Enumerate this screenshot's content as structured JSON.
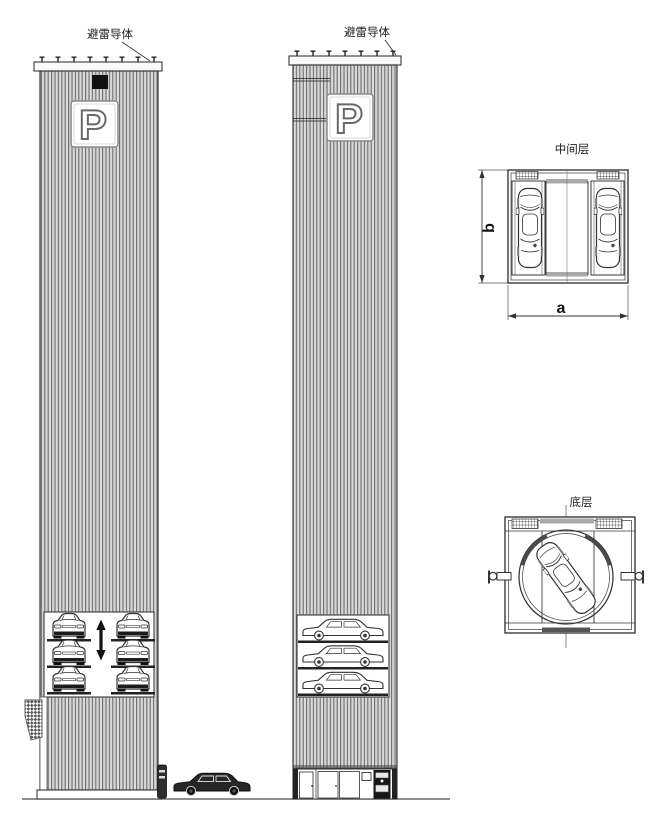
{
  "front_elevation": {
    "lightning_label": "避雷导体",
    "sign_letter": "P",
    "car_count": 6
  },
  "side_elevation": {
    "lightning_label": "避雷导体",
    "sign_letter": "P",
    "car_count": 3
  },
  "middle_floor_plan": {
    "title": "中间层",
    "dim_width_label": "a",
    "dim_depth_label": "b",
    "car_count": 2
  },
  "bottom_floor_plan": {
    "title": "底层",
    "car_count": 1
  },
  "street": {
    "car_count": 1
  },
  "colors": {
    "background": "#ffffff",
    "line": "#3a3a3a",
    "cladding_stripe": "#707070",
    "cladding_bg": "#e8e8e8",
    "dark_fill": "#1a1a1a",
    "gray_strip": "#aaaaaa"
  }
}
